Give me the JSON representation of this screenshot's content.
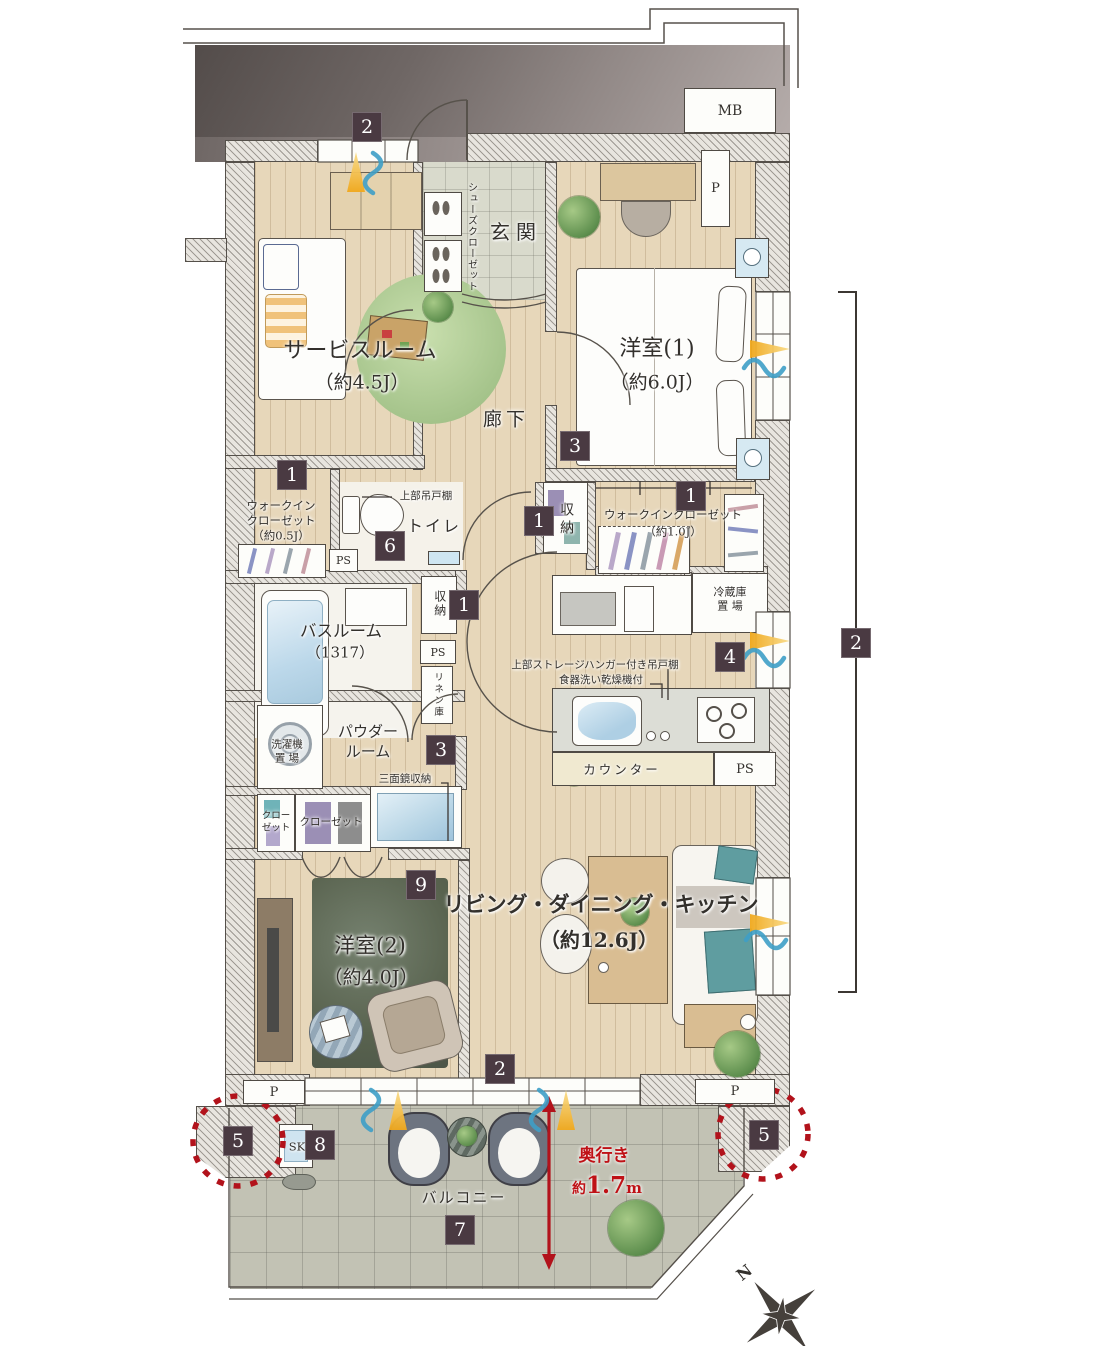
{
  "rooms": {
    "service": {
      "name": "サービスルーム",
      "size": "（約4.5J）"
    },
    "genkan": {
      "name": "玄関",
      "shoes_closet": "シューズクローゼット"
    },
    "hallway": {
      "name": "廊下"
    },
    "west1": {
      "name": "洋室(1)",
      "size": "（約6.0J）"
    },
    "west2": {
      "name": "洋室(2)",
      "size": "（約4.0J）"
    },
    "ldk": {
      "name": "リビング・ダイニング・キッチン",
      "size": "（約12.6J）"
    },
    "bathroom": {
      "name": "バスルーム",
      "size": "（1317）"
    },
    "toilet": {
      "name": "トイレ",
      "shelf": "上部吊戸棚"
    },
    "wic_small": {
      "line1": "ウォークイン",
      "line2": "クローゼット",
      "size": "（約0.5J）"
    },
    "wic_large": {
      "name": "ウォークインクローゼット",
      "size": "（約1.0J）"
    },
    "storage_mid": {
      "name": "収納"
    },
    "storage_low": {
      "name": "収納"
    },
    "linen": {
      "name": "リネン庫"
    },
    "fridge": {
      "line1": "冷蔵庫",
      "line2": "置 場"
    },
    "kitchen": {
      "note_line1": "上部ストレージハンガー付き吊戸棚",
      "note_line2": "食器洗い乾燥機付",
      "counter": "カウンター"
    },
    "laundry": {
      "line1": "洗濯機",
      "line2": "置 場"
    },
    "powder": {
      "line1": "パウダー",
      "line2": "ルーム",
      "mirror": "三面鏡収納"
    },
    "closet_small": {
      "line1": "クロー",
      "line2": "ゼット"
    },
    "closet_wide": {
      "name": "クローゼット"
    },
    "balcony": {
      "name": "バルコニー",
      "sink": "SK"
    }
  },
  "utilities": {
    "mb": "MB",
    "p_top": "P",
    "p_bottom_left": "P",
    "p_bottom_right": "P",
    "ps_toilet": "PS",
    "ps_hall": "PS",
    "ps_kitchen": "PS"
  },
  "badges": {
    "entry_window": "2",
    "wic_small": "1",
    "toilet": "6",
    "storage_mid": "1",
    "storage_low": "1",
    "wic_large": "1",
    "west1": "3",
    "right_wall": "2",
    "kitchen": "4",
    "powder": "3",
    "west2": "9",
    "south_window": "2",
    "pillar_left": "5",
    "slop_sink": "8",
    "balcony": "7",
    "pillar_right": "5"
  },
  "annotations": {
    "depth_title": "奥行き",
    "depth_approx": "約",
    "depth_value": "1.7",
    "depth_unit": "m",
    "compass_north": "N"
  },
  "colors": {
    "badge": "#4a3a42",
    "red": "#bf1116",
    "wood": "#e7d7ba",
    "balcony_tile": "#c2c2b4",
    "dark_corridor": "#534c4a",
    "hatch_line": "#5a554f",
    "light_cone": "#f0a81c",
    "wind_wave": "#3e9ec6"
  }
}
